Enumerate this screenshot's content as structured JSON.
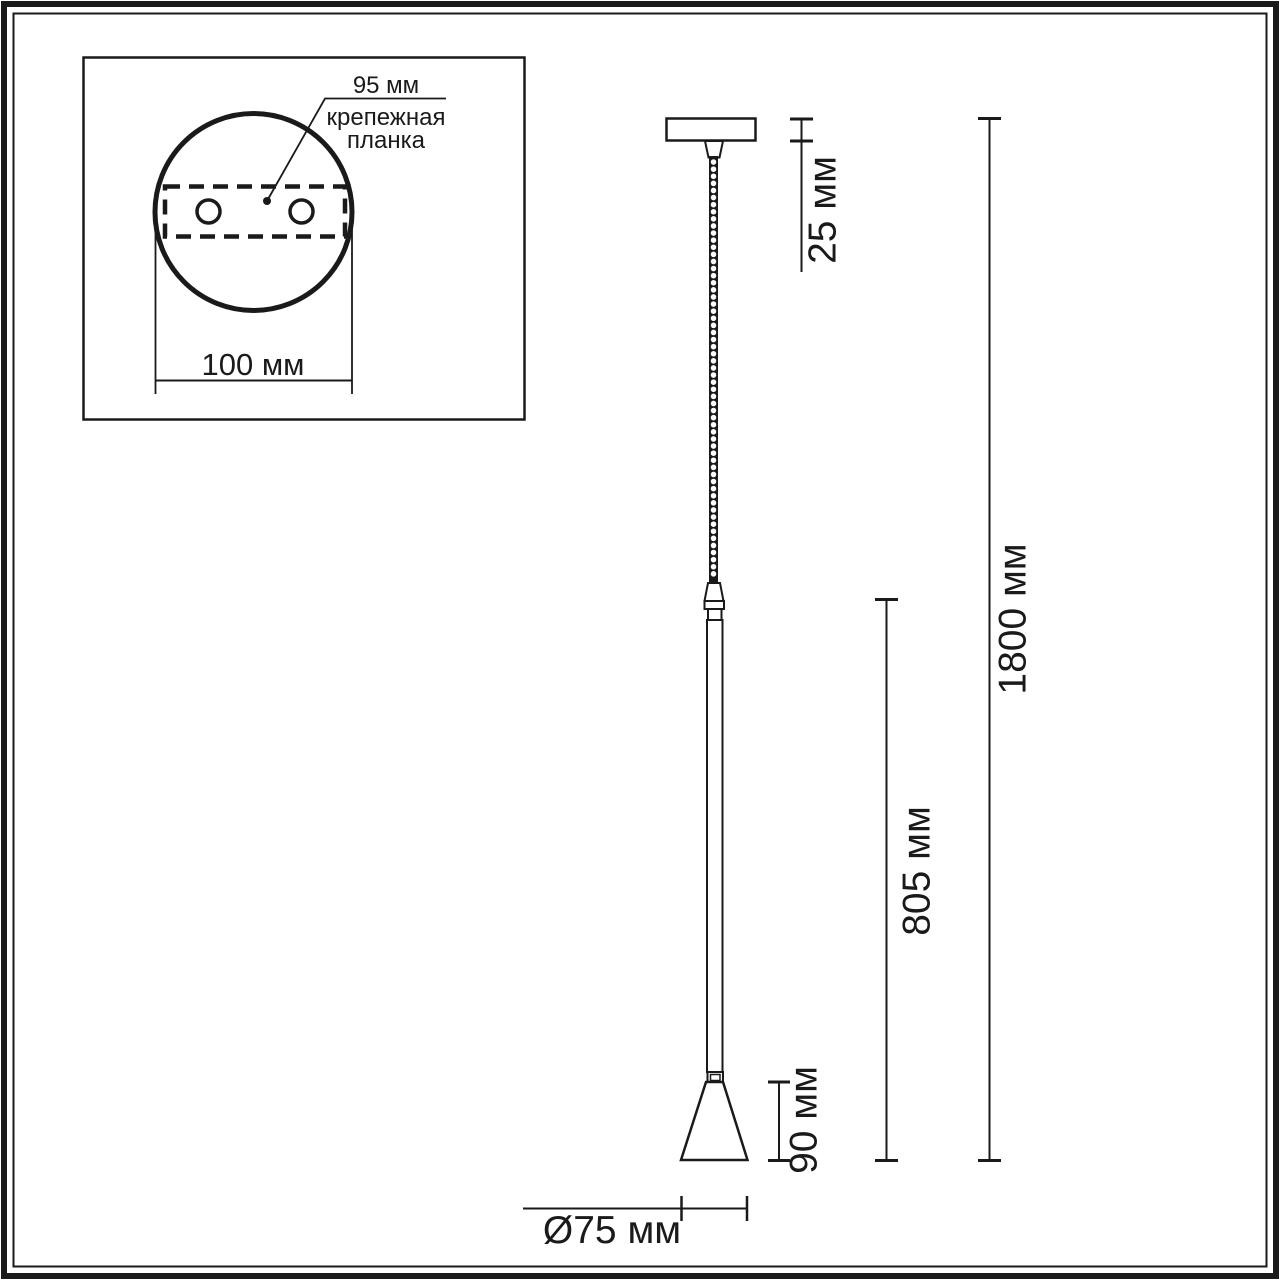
{
  "colors": {
    "line": "#1a1a1a",
    "background": "#ffffff"
  },
  "inset": {
    "callout_value": "95 мм",
    "callout_label_line1": "крепежная",
    "callout_label_line2": "планка",
    "width_dimension": "100 мм"
  },
  "dimensions": {
    "canopy_height": "25 мм",
    "overall_height": "1800 мм",
    "stem_length": "805 мм",
    "shade_height": "90 мм",
    "shade_diameter": "Ø75 мм"
  }
}
